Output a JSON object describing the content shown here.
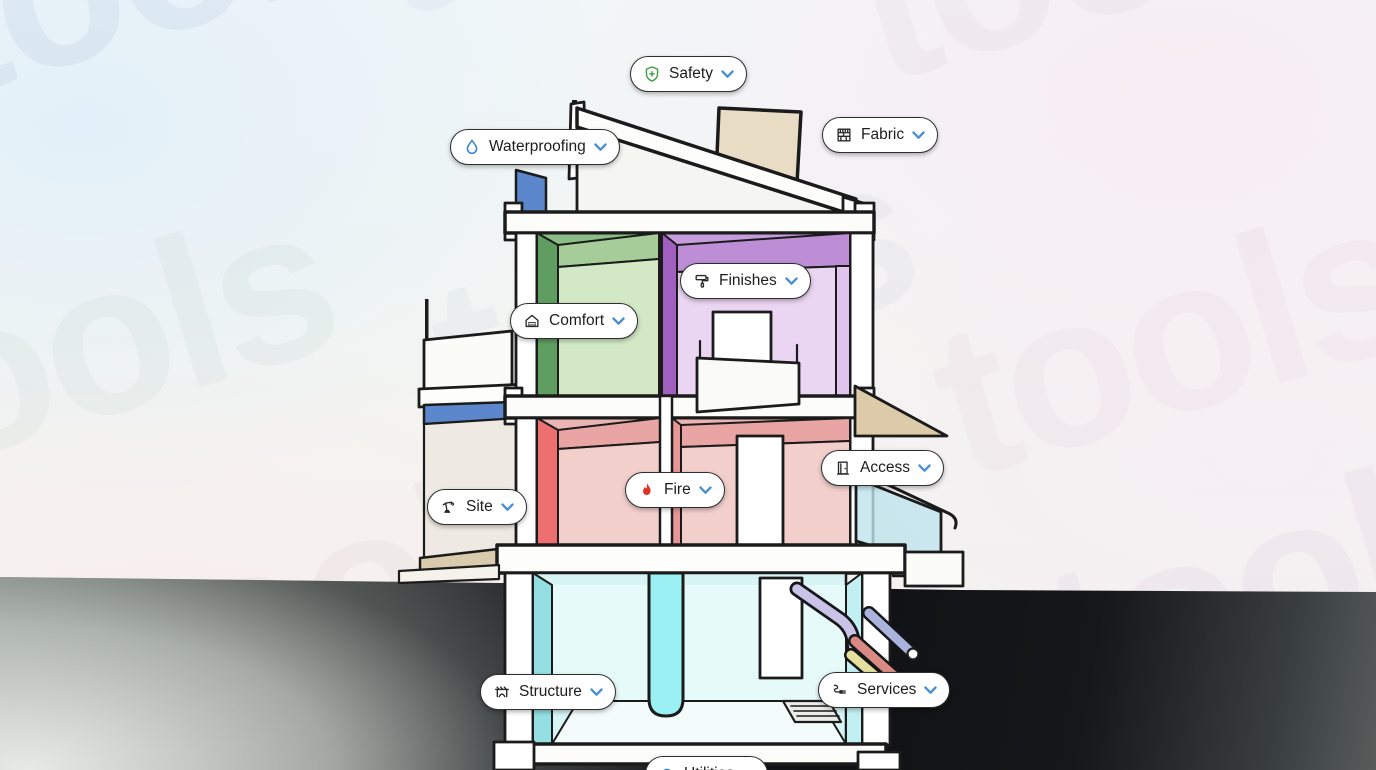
{
  "watermark": {
    "text": "tools",
    "tm": "™"
  },
  "buttons": [
    {
      "id": "safety",
      "label": "Safety",
      "icon": "shield-plus-icon"
    },
    {
      "id": "waterproofing",
      "label": "Waterproofing",
      "icon": "water-drop-icon"
    },
    {
      "id": "fabric",
      "label": "Fabric",
      "icon": "wall-section-icon"
    },
    {
      "id": "finishes",
      "label": "Finishes",
      "icon": "paint-roller-icon"
    },
    {
      "id": "comfort",
      "label": "Comfort",
      "icon": "insulated-house-icon"
    },
    {
      "id": "fire",
      "label": "Fire",
      "icon": "flame-icon"
    },
    {
      "id": "access",
      "label": "Access",
      "icon": "door-icon"
    },
    {
      "id": "site",
      "label": "Site",
      "icon": "crane-icon"
    },
    {
      "id": "structure",
      "label": "Structure",
      "icon": "bridge-arch-icon"
    },
    {
      "id": "services",
      "label": "Services",
      "icon": "cable-plug-icon"
    },
    {
      "id": "utilities",
      "label": "Utilities",
      "icon": "utilities-icon"
    }
  ],
  "colors": {
    "chevron_blue": "#4a8fd3",
    "icon_green": "#43a047",
    "icon_blue": "#3b82d4",
    "icon_red": "#e23125",
    "icon_dark": "#2a2a2a",
    "pill_border": "#2e2e2e",
    "waterproof_blue": "#5d87cc",
    "glass_blue": "#aac6e8",
    "beige": "#e9dcc4",
    "beige_canopy": "#dccaa8",
    "beige_floor": "#d8cbae",
    "green_dark": "#5f9e60",
    "green_mid": "#8dbd86",
    "green_ceiling": "#a6cc9a",
    "green_light": "#d3e9c6",
    "purple_dark": "#a160bf",
    "purple_mid": "#c59ddc",
    "purple_ceiling": "#bd8ed6",
    "purple_light": "#ead5f2",
    "red_face": "#ee6f70",
    "pink_mid": "#eab4b2",
    "pink_ceiling": "#e8a5a3",
    "pink_light": "#f3cfcc",
    "cyan_face": "#93dfe2",
    "cyan_bg": "#d8f5f6",
    "cyan_back": "#e6faf9",
    "cyan_column": "#9af0f2",
    "stair_glass": "#bfe4ec",
    "pipe_lavender": "#c9c3e8",
    "pipe_blue": "#a9b3dc",
    "pipe_red": "#d98a83",
    "pipe_yellow": "#e5e09c"
  }
}
